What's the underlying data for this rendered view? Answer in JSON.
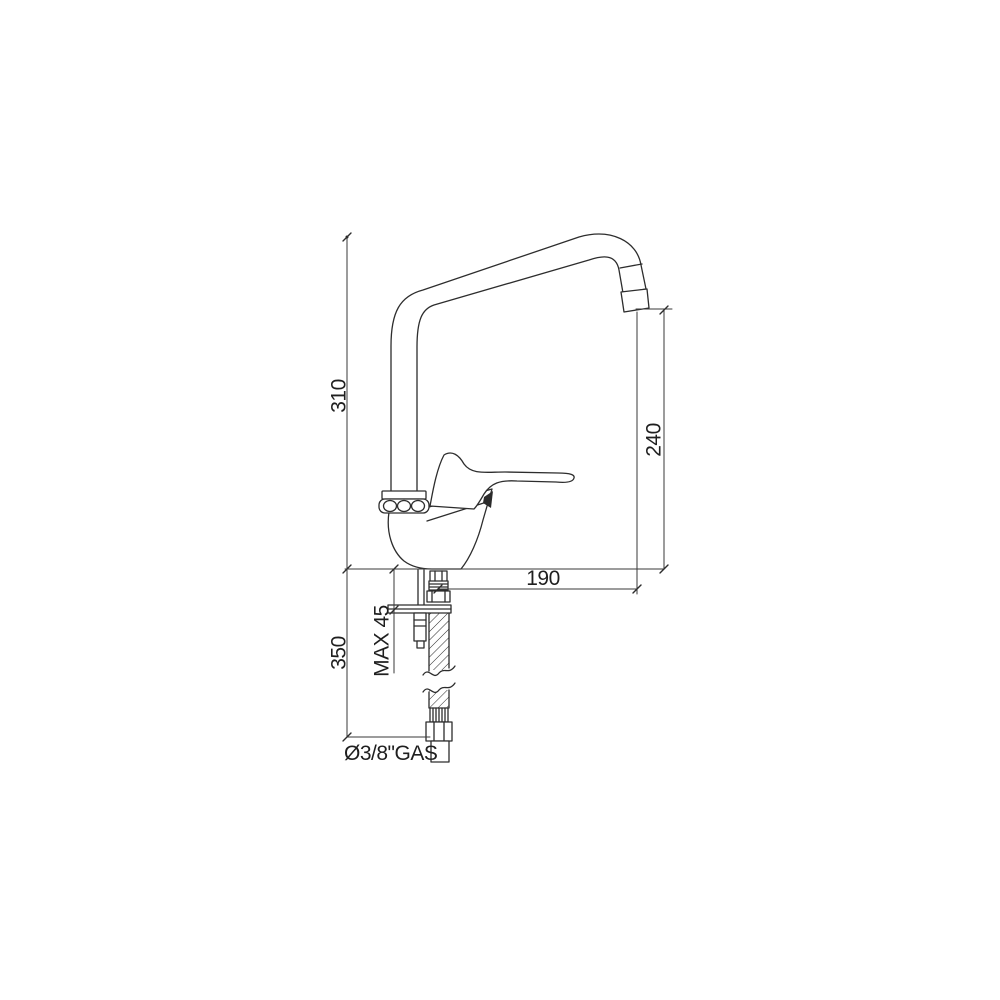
{
  "drawing": {
    "subject": "single-lever-kitchen-mixer-tap-side-elevation",
    "background_color": "#ffffff",
    "object_line_color": "#2d2d2d",
    "dimension_line_color": "#3a3a3a",
    "dimensions": {
      "spout_height": {
        "label": "310",
        "orientation": "vertical-left"
      },
      "outlet_height": {
        "label": "240",
        "orientation": "vertical-right"
      },
      "spout_reach": {
        "label": "190",
        "orientation": "horizontal"
      },
      "supply_hose_length": {
        "label": "350",
        "orientation": "vertical-lower-left"
      },
      "max_deck_thickness": {
        "label": "MAX 45",
        "orientation": "vertical-note"
      },
      "connection_thread": {
        "label": "Ø3/8\"GAS",
        "orientation": "horizontal-note"
      }
    }
  }
}
